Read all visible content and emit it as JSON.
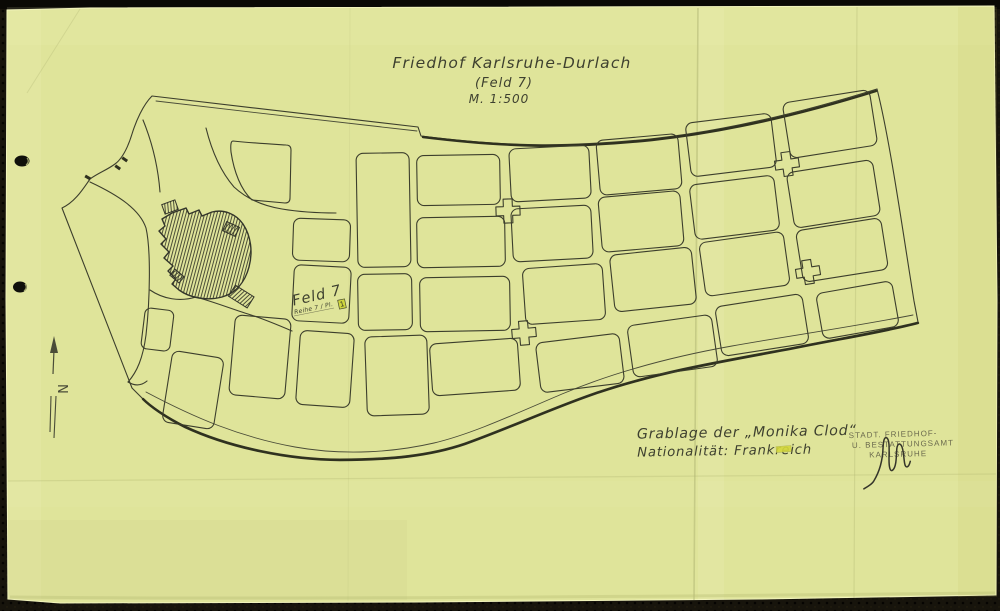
{
  "document": {
    "title": "Friedhof Karlsruhe-Durlach",
    "subtitle": "(Feld 7)",
    "scale": "M. 1:500"
  },
  "map": {
    "field_label": "Feld 7",
    "field_sublabel": "Reihe 7 / Pl.",
    "field_plot_number": "1",
    "north_label": "N"
  },
  "annotations": {
    "grave_line1": "Grablage der „Monika Clod“",
    "grave_line2": "Nationalität: Frankreich"
  },
  "stamp": {
    "line1": "STADT. FRIEDHOF-",
    "line2": "U. BESTATTUNGSAMT",
    "line3": "KARLSRUHE"
  },
  "colors": {
    "paper": "#dfe49a",
    "ink": "#3c3e2c",
    "highlight": "#cfd63e",
    "scanner_bed": "#17140c"
  }
}
